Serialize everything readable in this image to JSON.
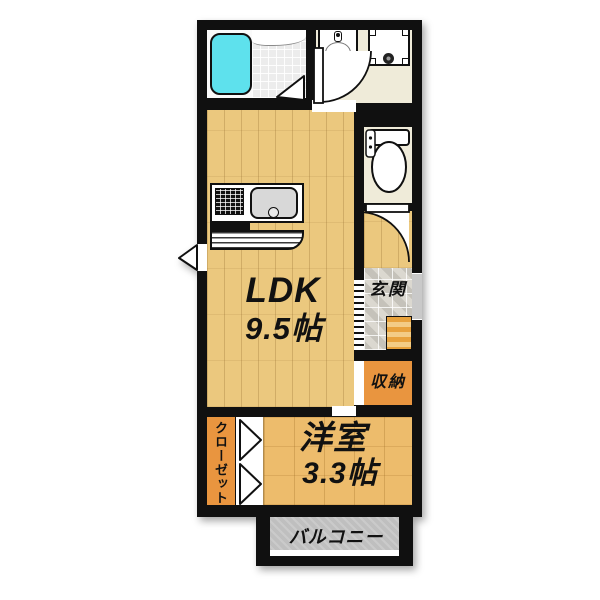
{
  "plan_title": "apartment-floor-plan",
  "rooms": {
    "ldk": {
      "label": "LDK",
      "size": "9.5帖"
    },
    "western": {
      "label": "洋室",
      "size": "3.3帖"
    },
    "entrance": {
      "label": "玄関"
    },
    "storage": {
      "label": "収納"
    },
    "closet": {
      "label": "クローゼット"
    },
    "balcony": {
      "label": "バルコニー"
    }
  },
  "fixtures": {
    "bathtub": "rounded-cyan-tub",
    "shower_room": "tiled-floor-with-door",
    "washbasin": "vanity-basin",
    "washer_pan": "square-pan-with-drain",
    "toilet": "tank-and-bowl",
    "stove": "black-burner-grid",
    "kitchen_sink": "gray-rounded-sink",
    "entrance_step": "striped-step",
    "front_door": "gray-wall-gap",
    "window_marker": "triangle-vent",
    "closet_doors": "double-triangle-folding-doors",
    "door_swings": "quarter-circle-arcs"
  },
  "colors": {
    "wall": "#101010",
    "bathtub": "#5EE1ED",
    "ldk_floor": "#EBC87E",
    "western_floor": "#EDBC6C",
    "accent_orange": "#E9953F",
    "washroom_cream": "#EFEBD9",
    "entrance_tile": "#DBD8D0",
    "balcony_gray": "#BFBFBF",
    "background": "#FFFFFF"
  }
}
